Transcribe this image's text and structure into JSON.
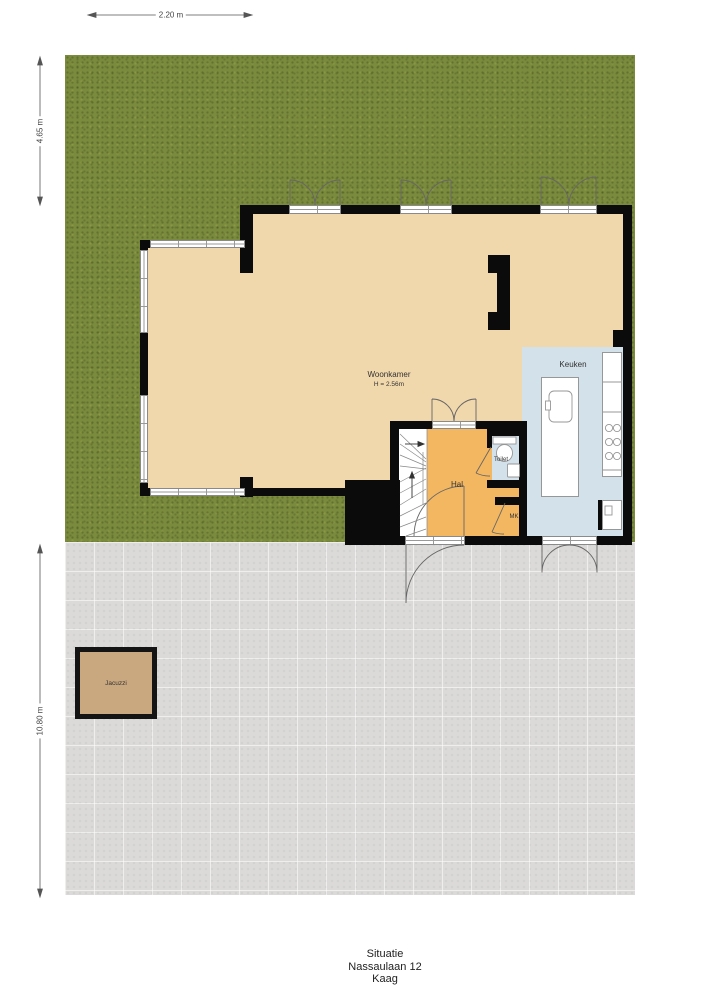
{
  "title_block": {
    "line1": "Situatie",
    "line2": "Nassaulaan 12",
    "line3": "Kaag"
  },
  "dimensions": {
    "top_width": "2.20 m",
    "left_upper_height": "4.65 m",
    "left_lower_height": "10.80 m"
  },
  "rooms": {
    "woonkamer": {
      "label": "Woonkamer",
      "height_note": "H = 2.56m"
    },
    "keuken": {
      "label": "Keuken"
    },
    "hal": {
      "label": "Hal"
    },
    "toilet": {
      "label": "Toilet"
    },
    "meterkast": {
      "label": "MK"
    },
    "jacuzzi": {
      "label": "Jacuzzi"
    }
  },
  "colors": {
    "grass": "#7b8b3d",
    "paving": "#dbdad8",
    "floor_wood": "#f1d7ac",
    "kitchen_floor": "#d3e1ea",
    "hall_floor": "#f4b761",
    "jacuzzi_fill": "#c9a87f",
    "wall": "#0b0b0b",
    "dimension_line": "#555555"
  }
}
